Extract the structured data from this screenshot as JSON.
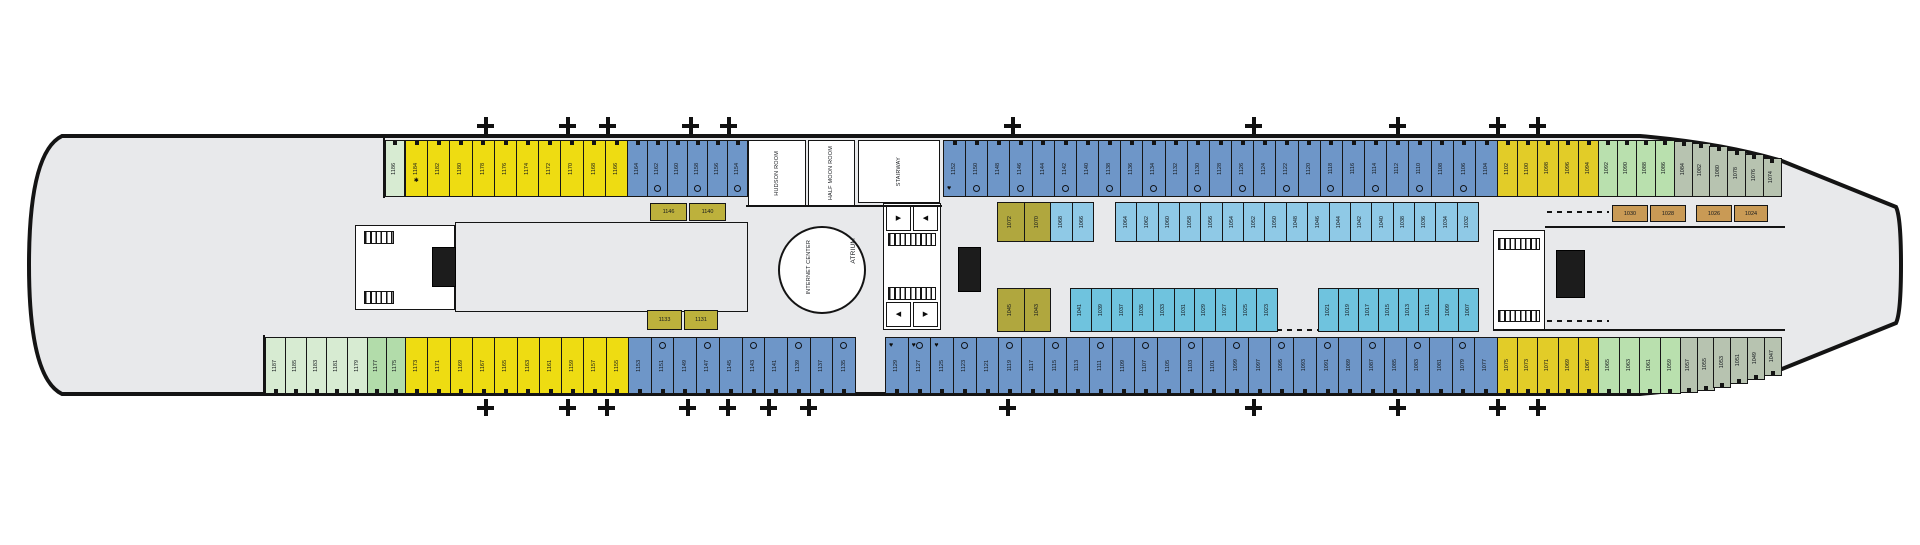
{
  "meta": {
    "description": "Cruise ship deck plan, bow to the right"
  },
  "labels": {
    "hudson_room": "HUDSON ROOM",
    "half_moon_room": "HALF MOON ROOM",
    "stairway": "STAIRWAY",
    "internet_center": "INTERNET CENTER",
    "atrium": "ATRIUM"
  },
  "colors": {
    "hull_fill": "#e8e9eb",
    "hull_line": "#141414",
    "blue": "#6e96c8",
    "lightblue": "#8fc9e6",
    "lightblue2": "#6fc3de",
    "yellow": "#eedc12",
    "yellow2": "#e2cc28",
    "green_pale": "#d7ebd2",
    "green_med": "#b2dcaa",
    "green": "#b9e0ae",
    "graygreen": "#b7c3b0",
    "olive": "#b0a73e",
    "olive_box": "#bdb13c",
    "tan": "#c99a55"
  },
  "plus_marks": {
    "top_y": 117,
    "bottom_y": 399,
    "top_x": [
      485,
      567,
      607,
      690,
      728,
      1012,
      1253,
      1397,
      1497,
      1537
    ],
    "bottom_x": [
      485,
      567,
      606,
      687,
      727,
      768,
      808,
      1007,
      1253,
      1397,
      1497,
      1537
    ]
  },
  "rows": [
    {
      "id": "top-outer-row",
      "y": 140,
      "h": 57,
      "door": "top",
      "mark_side": "bottom",
      "segs": [
        {
          "c": "green_pale",
          "x": 385,
          "w": 19,
          "start": 1186,
          "step": -2,
          "count": 1
        },
        {
          "c": "yellow",
          "x": 405,
          "w": 22.2,
          "start": 1184,
          "step": -2,
          "count": 10,
          "star_first": 1
        },
        {
          "c": "blue",
          "x": 627,
          "w": 20,
          "start": 1164,
          "step": -2,
          "count": 6,
          "ring_every": 2
        },
        {
          "c": "blue",
          "x": 943,
          "w": 22.16,
          "start": 1152,
          "step": -2,
          "count": 25,
          "ring_every": 2,
          "acc_first": 1
        },
        {
          "c": "yellow2",
          "x": 1497,
          "w": 20.2,
          "start": 1102,
          "step": -2,
          "count": 5
        },
        {
          "c": "green",
          "x": 1598,
          "w": 19,
          "start": 1092,
          "step": -2,
          "count": 4
        },
        {
          "c": "graygreen",
          "x": 1674,
          "w": 17.7,
          "start": 1084,
          "step": -2,
          "count": 6,
          "taper": "top",
          "taper_offsets": [
            1,
            3,
            6,
            10,
            14,
            18
          ]
        }
      ]
    },
    {
      "id": "top-inner-row",
      "y": 202,
      "h": 40,
      "door": "none",
      "mark_side": "none",
      "segs": [
        {
          "c": "olive",
          "x": 997,
          "w": 26.5,
          "start": 1072,
          "step": -2,
          "count": 2
        },
        {
          "c": "lightblue",
          "x": 1050,
          "w": 21.5,
          "start": 1068,
          "step": -2,
          "count": 2
        },
        {
          "c": "lightblue",
          "x": 1115,
          "w": 21.35,
          "start": 1064,
          "step": -2,
          "count": 17
        }
      ]
    },
    {
      "id": "bottom-inner-row",
      "y": 288,
      "h": 44,
      "door": "none",
      "mark_side": "none",
      "segs": [
        {
          "c": "olive",
          "x": 997,
          "w": 26.5,
          "start": 1045,
          "step": -2,
          "count": 2
        },
        {
          "c": "lightblue2",
          "x": 1070,
          "w": 20.7,
          "start": 1041,
          "step": -2,
          "count": 10
        },
        {
          "c": "lightblue2",
          "x": 1318,
          "w": 20,
          "start": 1021,
          "step": -2,
          "count": 8
        }
      ]
    },
    {
      "id": "bottom-outer-row",
      "y": 337,
      "h": 57,
      "door": "bottom",
      "mark_side": "top",
      "segs": [
        {
          "c": "green_pale",
          "x": 265,
          "w": 20.4,
          "start": 1187,
          "step": -2,
          "count": 5
        },
        {
          "c": "green_med",
          "x": 367,
          "w": 19,
          "start": 1177,
          "step": -2,
          "count": 2
        },
        {
          "c": "yellow",
          "x": 405,
          "w": 22.3,
          "start": 1173,
          "step": -2,
          "count": 10
        },
        {
          "c": "blue",
          "x": 628,
          "w": 22.7,
          "start": 1153,
          "step": -2,
          "count": 10,
          "ring_every": 2
        },
        {
          "c": "blue",
          "x": 885,
          "w": 22.66,
          "start": 1129,
          "step": -2,
          "count": 27,
          "ring_every": 2,
          "acc_first": 3
        },
        {
          "c": "yellow2",
          "x": 1497,
          "w": 20.2,
          "start": 1075,
          "step": -2,
          "count": 5
        },
        {
          "c": "green",
          "x": 1598,
          "w": 20.5,
          "start": 1065,
          "step": -2,
          "count": 4
        },
        {
          "c": "graygreen",
          "x": 1680,
          "w": 16.7,
          "start": 1057,
          "step": -2,
          "count": 6,
          "taper": "bottom",
          "taper_offsets": [
            1,
            3,
            6,
            10,
            14,
            18
          ]
        }
      ]
    }
  ],
  "inner_boxes": [
    {
      "x": 650,
      "y": 203,
      "w": 37,
      "h": 18,
      "c": "olive_box",
      "label": "1146"
    },
    {
      "x": 689,
      "y": 203,
      "w": 37,
      "h": 18,
      "c": "olive_box",
      "label": "1140"
    },
    {
      "x": 647,
      "y": 310,
      "w": 35,
      "h": 20,
      "c": "olive_box",
      "label": "1133"
    },
    {
      "x": 684,
      "y": 310,
      "w": 34,
      "h": 20,
      "c": "olive_box",
      "label": "1131"
    },
    {
      "x": 1612,
      "y": 205,
      "w": 36,
      "h": 17,
      "c": "tan",
      "label": "1030"
    },
    {
      "x": 1650,
      "y": 205,
      "w": 36,
      "h": 17,
      "c": "tan",
      "label": "1028"
    },
    {
      "x": 1696,
      "y": 205,
      "w": 36,
      "h": 17,
      "c": "tan",
      "label": "1026"
    },
    {
      "x": 1734,
      "y": 205,
      "w": 34,
      "h": 17,
      "c": "tan",
      "label": "1024"
    }
  ],
  "rooms": [
    {
      "name": "hudson-room",
      "x": 748,
      "y": 140,
      "w": 58,
      "h": 66,
      "label_key": "hudson_room"
    },
    {
      "name": "half-moon-room",
      "x": 808,
      "y": 140,
      "w": 47,
      "h": 66,
      "label_key": "half_moon_room"
    },
    {
      "name": "stairway-landing",
      "x": 858,
      "y": 140,
      "w": 82,
      "h": 63,
      "label_key": "stairway"
    },
    {
      "name": "aft-stair-lobby",
      "x": 355,
      "y": 225,
      "w": 100,
      "h": 85,
      "label_key": ""
    },
    {
      "name": "mid-stair-lobby",
      "x": 883,
      "y": 203,
      "w": 58,
      "h": 127,
      "label_key": ""
    },
    {
      "name": "fwd-stair-lobby",
      "x": 1493,
      "y": 230,
      "w": 52,
      "h": 100,
      "label_key": ""
    },
    {
      "name": "aft-lounge-area",
      "x": 455,
      "y": 222,
      "w": 293,
      "h": 90,
      "label_key": "",
      "transparent": true
    }
  ],
  "atrium_circle": {
    "x": 778,
    "y": 226,
    "d": 84
  },
  "atrium_label_pos": {
    "x": 850,
    "y": 238
  },
  "internet_label_pos": {
    "x": 806,
    "y": 240
  },
  "elevator_shafts": [
    {
      "x": 432,
      "y": 247,
      "w": 24,
      "h": 40
    },
    {
      "x": 958,
      "y": 247,
      "w": 23,
      "h": 45
    },
    {
      "x": 1556,
      "y": 250,
      "w": 29,
      "h": 48
    }
  ],
  "stair_hatches": [
    {
      "x": 364,
      "y": 231,
      "w": 30,
      "h": 13
    },
    {
      "x": 364,
      "y": 291,
      "w": 30,
      "h": 13
    },
    {
      "x": 888,
      "y": 233,
      "w": 48,
      "h": 13
    },
    {
      "x": 888,
      "y": 287,
      "w": 48,
      "h": 13
    },
    {
      "x": 1498,
      "y": 238,
      "w": 42,
      "h": 12
    },
    {
      "x": 1498,
      "y": 310,
      "w": 42,
      "h": 12
    }
  ],
  "wc_boxes": [
    {
      "x": 886,
      "y": 206,
      "w": 25,
      "h": 25,
      "glyph": "▶"
    },
    {
      "x": 913,
      "y": 206,
      "w": 25,
      "h": 25,
      "glyph": "◀"
    },
    {
      "x": 886,
      "y": 302,
      "w": 25,
      "h": 25,
      "glyph": "◀"
    },
    {
      "x": 913,
      "y": 302,
      "w": 25,
      "h": 25,
      "glyph": "▶"
    }
  ],
  "walls": [
    {
      "x": 383,
      "y": 136,
      "w": 2,
      "h": 62
    },
    {
      "x": 263,
      "y": 335,
      "w": 2,
      "h": 59
    },
    {
      "x": 1545,
      "y": 226,
      "w": 240,
      "h": 2
    },
    {
      "x": 1493,
      "y": 329,
      "w": 292,
      "h": 2
    },
    {
      "x": 746,
      "y": 205,
      "w": 196,
      "h": 2
    }
  ],
  "dashes": [
    {
      "x": 1547,
      "y": 211,
      "w": 62
    },
    {
      "x": 1547,
      "y": 320,
      "w": 62
    },
    {
      "x": 1277,
      "y": 329,
      "w": 41
    }
  ],
  "marks": {
    "acc_glyph": "♥",
    "star_glyph": "✱"
  }
}
